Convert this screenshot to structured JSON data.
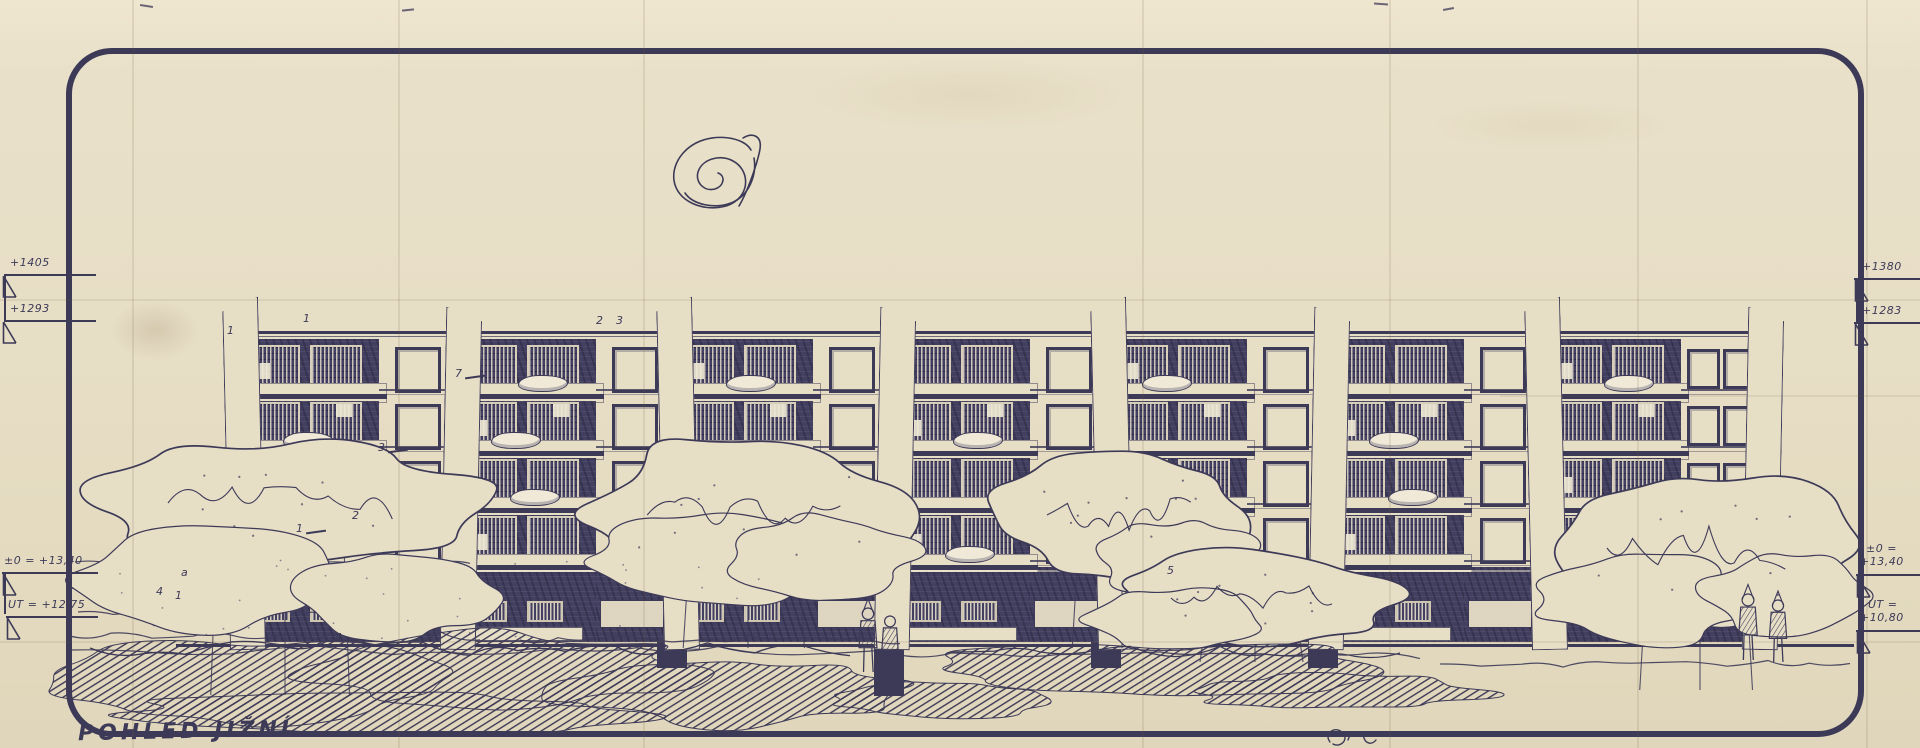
{
  "document": {
    "title": "POHLED JIŽNÍ"
  },
  "markers": {
    "left_top": [
      {
        "label": "+1405"
      },
      {
        "label": "+1293"
      }
    ],
    "right_top": [
      {
        "label": "+1380"
      },
      {
        "label": "+1283"
      }
    ],
    "left_bottom": [
      {
        "label": "±0 = +13,40"
      },
      {
        "label": "UT = +12,75"
      }
    ],
    "right_bottom": [
      {
        "line1": "±0 =",
        "line2": "+13,40"
      },
      {
        "line1": "UT =",
        "line2": "+10,80"
      }
    ]
  },
  "annotations": [
    {
      "label": "1",
      "x": 227,
      "y": 324
    },
    {
      "label": "1",
      "x": 303,
      "y": 312
    },
    {
      "label": "2",
      "x": 596,
      "y": 314
    },
    {
      "label": "3",
      "x": 616,
      "y": 314
    },
    {
      "label": "7",
      "x": 455,
      "y": 367,
      "leader": true
    },
    {
      "label": "3",
      "x": 378,
      "y": 441,
      "leader": true
    },
    {
      "label": "2",
      "x": 352,
      "y": 509
    },
    {
      "label": "1",
      "x": 296,
      "y": 522,
      "leader": true
    },
    {
      "label": "a",
      "x": 181,
      "y": 566
    },
    {
      "label": "4",
      "x": 156,
      "y": 585
    },
    {
      "label": "1",
      "x": 175,
      "y": 589
    },
    {
      "label": "4",
      "x": 335,
      "y": 631
    },
    {
      "label": "5",
      "x": 1167,
      "y": 564
    }
  ],
  "building": {
    "floors": 4,
    "modules": 7,
    "laundry": [
      [
        0,
        1
      ],
      [
        0,
        2
      ],
      [
        0,
        3
      ],
      [
        1,
        0
      ],
      [
        1,
        1
      ],
      [
        1,
        2
      ],
      [
        2,
        0
      ],
      [
        2,
        2
      ],
      [
        2,
        3
      ],
      [
        3,
        1
      ],
      [
        3,
        3
      ],
      [
        4,
        0
      ],
      [
        4,
        2
      ],
      [
        5,
        1
      ],
      [
        5,
        2
      ],
      [
        6,
        0
      ],
      [
        6,
        3
      ]
    ]
  },
  "colors": {
    "paper": "#e7dec6",
    "ink": "#3d3a58",
    "panel": "#423f60"
  },
  "icons": {
    "logo": "logo-scribble-icon",
    "signature": "signature-scribble-icon",
    "level_mark": "level-flag-icon"
  }
}
